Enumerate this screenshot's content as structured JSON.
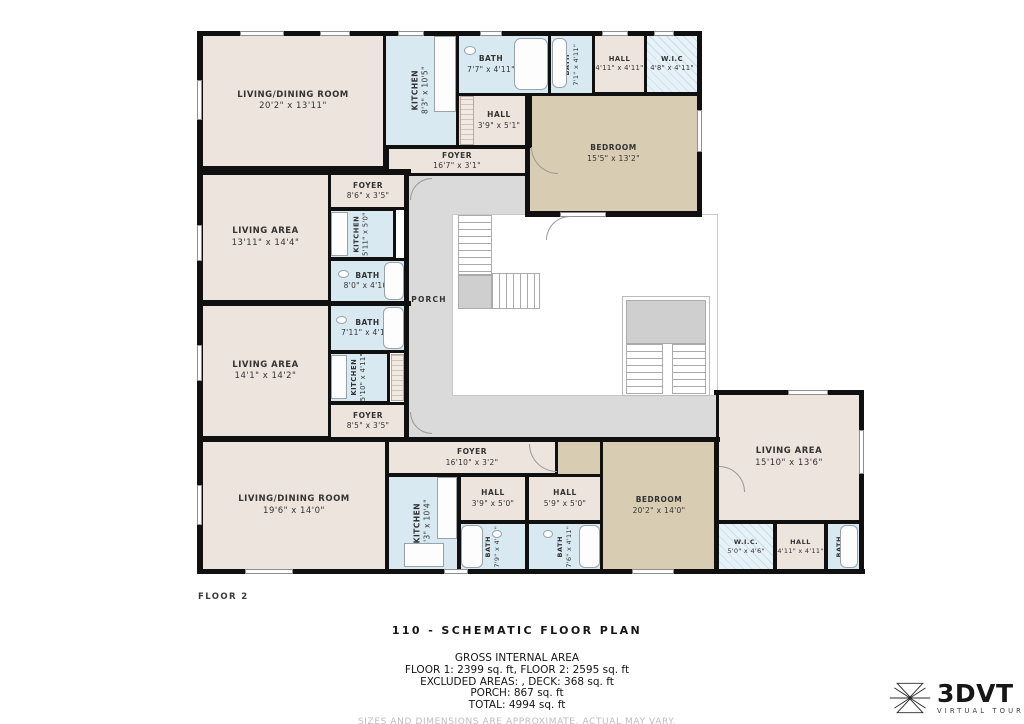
{
  "floor_label": "FLOOR 2",
  "title": "110 - SCHEMATIC FLOOR PLAN",
  "summary": {
    "heading": "GROSS INTERNAL AREA",
    "line1": "FLOOR 1: 2399 sq. ft, FLOOR 2: 2595 sq. ft",
    "line2": "EXCLUDED AREAS: , DECK: 368 sq. ft",
    "line3": "PORCH: 867 sq. ft",
    "line4": "TOTAL: 4994 sq. ft",
    "disclaimer": "SIZES AND DIMENSIONS ARE APPROXIMATE, ACTUAL MAY VARY."
  },
  "logo": {
    "brand": "3DVT",
    "tagline": "VIRTUAL TOUR"
  },
  "colors": {
    "living": "#EDE4DD",
    "bedroom": "#D8CDB3",
    "wet_rooms": "#D8E9F2",
    "porch": "#DADADA",
    "walls": "#101010"
  },
  "rooms": {
    "porch": {
      "name": "PORCH",
      "dims": ""
    },
    "living_dining_1": {
      "name": "LIVING/DINING ROOM",
      "dims": "20'2\" x 13'11\""
    },
    "kitchen_1": {
      "name": "KITCHEN",
      "dims": "8'3\" x 10'5\""
    },
    "bath_1": {
      "name": "BATH",
      "dims": "7'7\" x 4'11\""
    },
    "hall_1": {
      "name": "HALL",
      "dims": "3'9\" x 5'1\""
    },
    "bath_2": {
      "name": "BATH",
      "dims": "7'1\" x 4'11\""
    },
    "hall_2": {
      "name": "HALL",
      "dims": "4'11\" x 4'11\""
    },
    "wic_1": {
      "name": "W.I.C",
      "dims": "4'8\" x 4'11\""
    },
    "bedroom_1": {
      "name": "BEDROOM",
      "dims": "15'5\" x 13'2\""
    },
    "foyer_1": {
      "name": "FOYER",
      "dims": "16'7\" x 3'1\""
    },
    "foyer_2": {
      "name": "FOYER",
      "dims": "8'6\" x 3'5\""
    },
    "living_area_1": {
      "name": "LIVING AREA",
      "dims": "13'11\" x 14'4\""
    },
    "kitchen_2": {
      "name": "KITCHEN",
      "dims": "5'11\" x 5'0\""
    },
    "bath_3": {
      "name": "BATH",
      "dims": "8'0\" x 4'10\""
    },
    "bath_4": {
      "name": "BATH",
      "dims": "7'11\" x 4'10\""
    },
    "living_area_2": {
      "name": "LIVING AREA",
      "dims": "14'1\" x 14'2\""
    },
    "kitchen_3": {
      "name": "KITCHEN",
      "dims": "5'10\" x 4'11\""
    },
    "foyer_3": {
      "name": "FOYER",
      "dims": "8'5\" x 3'5\""
    },
    "foyer_4": {
      "name": "FOYER",
      "dims": "16'10\" x 3'2\""
    },
    "living_dining_2": {
      "name": "LIVING/DINING ROOM",
      "dims": "19'6\" x 14'0\""
    },
    "kitchen_4": {
      "name": "KITCHEN",
      "dims": "8'3\" x 10'4\""
    },
    "hall_3": {
      "name": "HALL",
      "dims": "3'9\" x 5'0\""
    },
    "hall_4": {
      "name": "HALL",
      "dims": "5'9\" x 5'0\""
    },
    "bath_5": {
      "name": "BATH",
      "dims": "7'9\" x 4'11\""
    },
    "bath_6": {
      "name": "BATH",
      "dims": "7'6\" x 4'11\""
    },
    "bedroom_2": {
      "name": "BEDROOM",
      "dims": "20'2\" x 14'0\""
    },
    "living_area_3": {
      "name": "LIVING AREA",
      "dims": "15'10\" x 13'6\""
    },
    "wic_2": {
      "name": "W.I.C.",
      "dims": "5'0\" x 4'6\""
    },
    "hall_5": {
      "name": "HALL",
      "dims": "4'11\" x 4'11\""
    },
    "bath_7": {
      "name": "BATH",
      "dims": "5'0\" x 4'11\""
    }
  }
}
